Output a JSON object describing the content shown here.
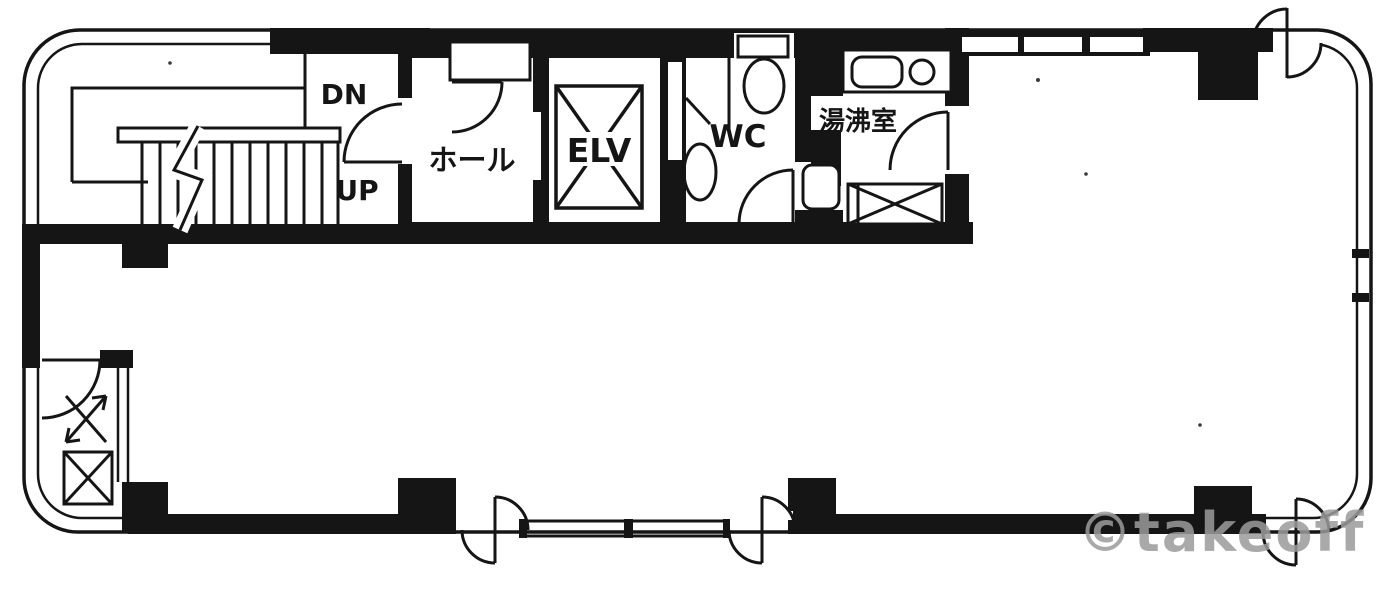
{
  "document": {
    "type": "floor-plan",
    "watermark": "©takeoff"
  },
  "colors": {
    "ink": "#151515",
    "background": "#ffffff",
    "watermark": "#9b9b9b"
  },
  "labels": {
    "stairs_down": "DN",
    "stairs_up": "UP",
    "hall": "ホール",
    "elevator": "ELV",
    "toilet": "WC",
    "kitchenette": "湯沸室"
  }
}
